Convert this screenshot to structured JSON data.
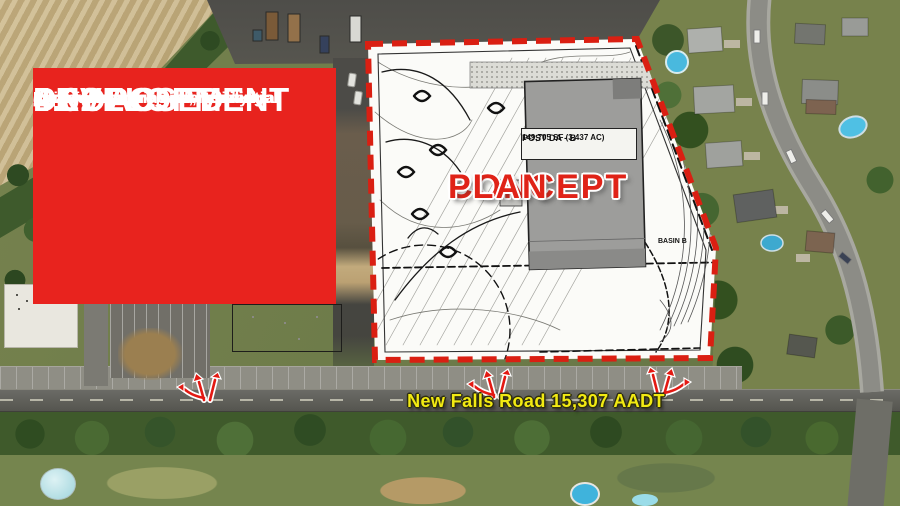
{
  "banner": {
    "title_lines": [
      "PROPOSED",
      "4.02 AC",
      "DEVELOPMENT"
    ],
    "description_lines": [
      "Redevelopment Opportunity",
      "Ideal for commercial, residential,",
      "or industrial projects, pending",
      "applicable zoning and municipal",
      "approvals."
    ],
    "bg_color": "#e8231e",
    "text_color": "#ffffff"
  },
  "concept_plan": {
    "watermark_lines": [
      "CONCEPT",
      "PLAN"
    ],
    "building_label": {
      "title": "POST DA - B",
      "area": "149,705 SF (3.437 AC)"
    },
    "basin_label": "BASIN B",
    "border_color": "#da1f12",
    "watermark_color": "#e02318"
  },
  "road": {
    "label": "New Falls Road 15,307 AADT",
    "label_color": "#f2ea12"
  },
  "traffic_arrows": {
    "count": 3,
    "color": "#e31912"
  }
}
